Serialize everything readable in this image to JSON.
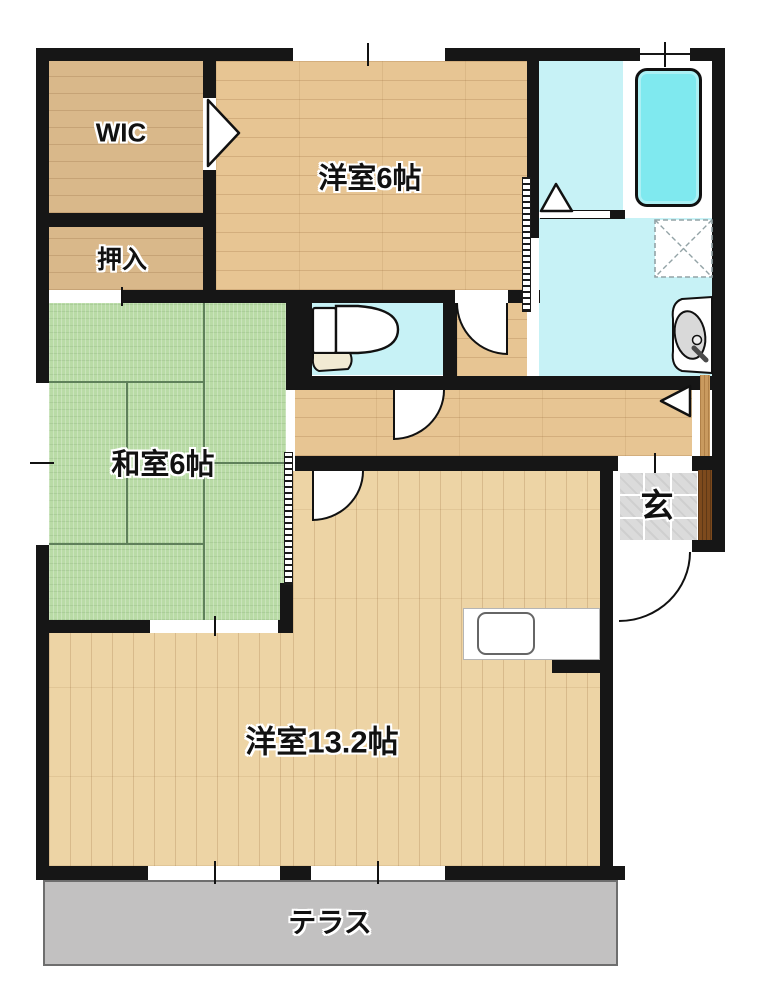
{
  "rooms": {
    "wic": {
      "label": "WIC"
    },
    "oshiire": {
      "label": "押入"
    },
    "western6": {
      "label": "洋室6帖"
    },
    "japanese6": {
      "label": "和室6帖"
    },
    "living": {
      "label": "洋室13.2帖"
    },
    "entrance": {
      "label": "玄"
    },
    "terrace": {
      "label": "テラス"
    }
  },
  "colors": {
    "wall": "#161616",
    "wood": "#e7c593",
    "wood_dark": "#d9b88a",
    "wood_light": "#edd4a5",
    "tatami": "#b9dba6",
    "water": "#c7f2f6",
    "tub": "#7fe9ef",
    "terrace": "#c2c1c1",
    "tile": "#dbdbdb",
    "cabinet_dark": "#7d4a1d",
    "cabinet_light": "#c99a5f",
    "fixture_beige": "#f1ead3"
  }
}
